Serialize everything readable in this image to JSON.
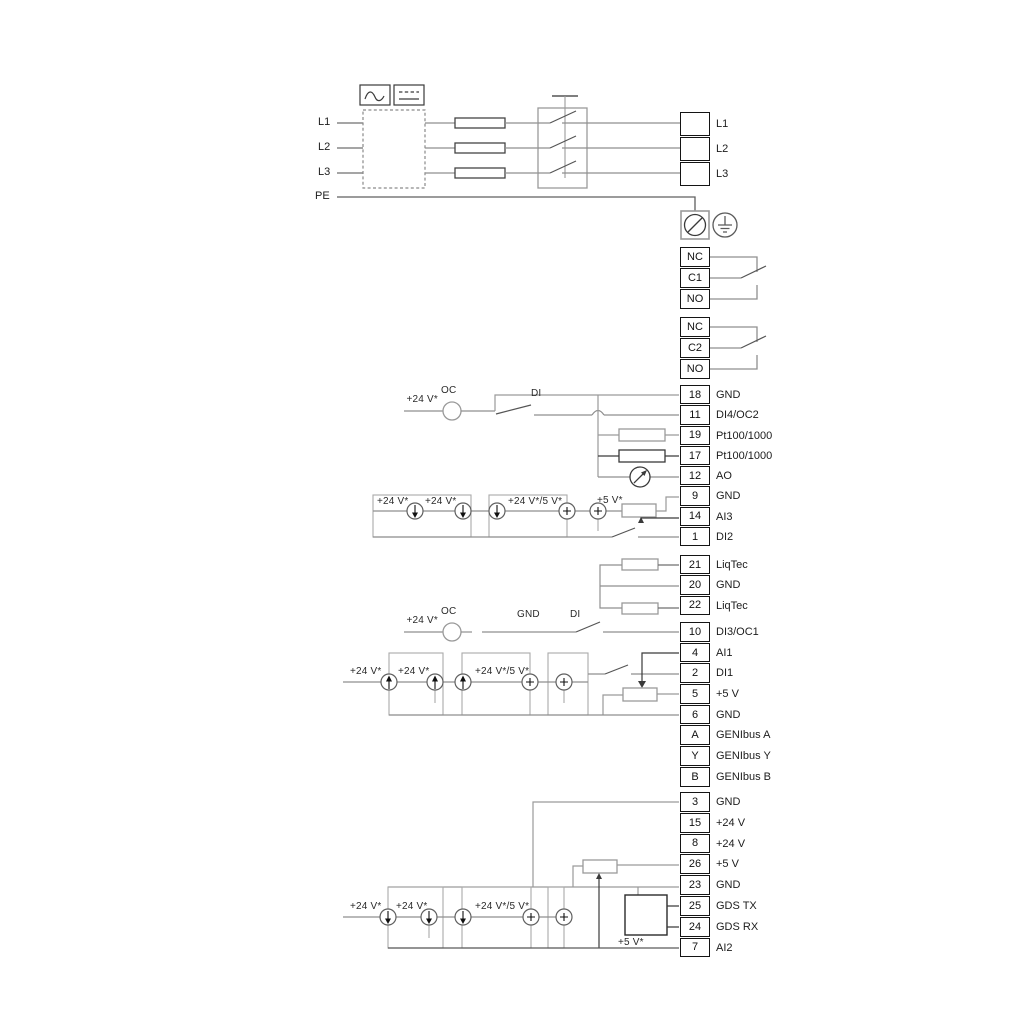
{
  "power": {
    "inputs": [
      "L1",
      "L2",
      "L3",
      "PE"
    ],
    "output_terminals": [
      "L1",
      "L2",
      "L3"
    ]
  },
  "relay1": {
    "terminals": [
      "NC",
      "C1",
      "NO"
    ]
  },
  "relay2": {
    "terminals": [
      "NC",
      "C2",
      "NO"
    ]
  },
  "io_group1": {
    "rows": [
      {
        "id": "18",
        "label": "GND"
      },
      {
        "id": "11",
        "label": "DI4/OC2"
      },
      {
        "id": "19",
        "label": "Pt100/1000"
      },
      {
        "id": "17",
        "label": "Pt100/1000"
      },
      {
        "id": "12",
        "label": "AO"
      },
      {
        "id": "9",
        "label": "GND"
      },
      {
        "id": "14",
        "label": "AI3"
      },
      {
        "id": "1",
        "label": "DI2"
      }
    ]
  },
  "liqtec_group": {
    "rows": [
      {
        "id": "21",
        "label": "LiqTec"
      },
      {
        "id": "20",
        "label": "GND"
      },
      {
        "id": "22",
        "label": "LiqTec"
      }
    ]
  },
  "io_group2": {
    "rows": [
      {
        "id": "10",
        "label": "DI3/OC1"
      },
      {
        "id": "4",
        "label": "AI1"
      },
      {
        "id": "2",
        "label": "DI1"
      },
      {
        "id": "5",
        "label": "+5 V"
      },
      {
        "id": "6",
        "label": "GND"
      },
      {
        "id": "A",
        "label": "GENIbus A"
      },
      {
        "id": "Y",
        "label": "GENIbus Y"
      },
      {
        "id": "B",
        "label": "GENIbus B"
      }
    ]
  },
  "io_group3": {
    "rows": [
      {
        "id": "3",
        "label": "GND"
      },
      {
        "id": "15",
        "label": "+24 V"
      },
      {
        "id": "8",
        "label": "+24 V"
      },
      {
        "id": "26",
        "label": "+5 V"
      },
      {
        "id": "23",
        "label": "GND"
      },
      {
        "id": "25",
        "label": "GDS TX"
      },
      {
        "id": "24",
        "label": "GDS RX"
      },
      {
        "id": "7",
        "label": "AI2"
      }
    ]
  },
  "annotations": {
    "v24": "+24 V*",
    "v24or5": "+24 V*/5 V*",
    "v5": "+5 V*",
    "oc": "OC",
    "di": "DI",
    "gnd": "GND"
  },
  "colors": {
    "wire_gray": "#8f8f8f",
    "wire_dark": "#333333",
    "terminal_border": "#141414"
  }
}
